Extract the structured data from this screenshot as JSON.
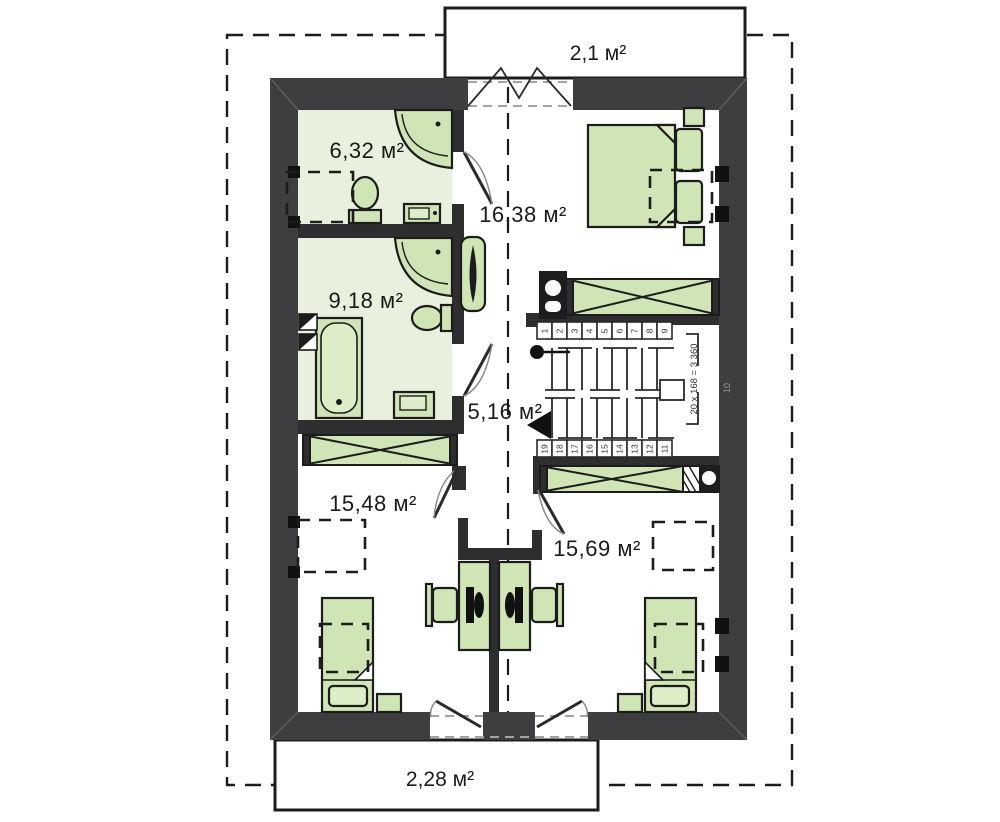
{
  "plan": {
    "type": "attic-floor-plan",
    "rooms": {
      "balcony_top": {
        "label": "2,1 м²"
      },
      "bathroom_small": {
        "label": "6,32 м²"
      },
      "bedroom_master": {
        "label": "16,38 м²"
      },
      "bathroom_large": {
        "label": "9,18 м²"
      },
      "hallway": {
        "label": "5,16 м²"
      },
      "bedroom_left": {
        "label": "15,48 м²"
      },
      "bedroom_right": {
        "label": "15,69 м²"
      },
      "balcony_bottom": {
        "label": "2,28 м²"
      }
    },
    "stairs": {
      "note": "20 x 168 = 3 360",
      "landing_step": "10",
      "steps_up": [
        "1",
        "2",
        "3",
        "4",
        "5",
        "6",
        "7",
        "8",
        "9"
      ],
      "steps_down": [
        "19",
        "18",
        "17",
        "16",
        "15",
        "14",
        "13",
        "12",
        "11"
      ]
    },
    "colors": {
      "wall": "#3e3e40",
      "furniture": "#cfe5b6",
      "bathroom_floor": "#e9f1de"
    }
  }
}
